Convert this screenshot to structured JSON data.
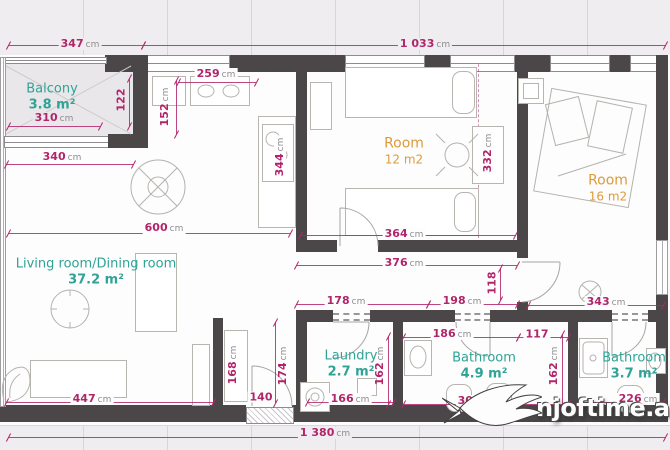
{
  "plan": {
    "rooms": [
      {
        "id": "balcony",
        "name": "Balcony",
        "area": "3.8 m²"
      },
      {
        "id": "living",
        "name": "Living room/Dining room",
        "area": "37.2 m²"
      },
      {
        "id": "room12",
        "name": "Room",
        "area": "12 m2"
      },
      {
        "id": "room16",
        "name": "Room",
        "area": "16 m2"
      },
      {
        "id": "laundry",
        "name": "Laundry",
        "area": "2.7 m²"
      },
      {
        "id": "bathroom-left",
        "name": "Bathroom",
        "area": "4.9 m²"
      },
      {
        "id": "bathroom-right",
        "name": "Bathroom",
        "area": "3.7 m²"
      }
    ],
    "dimensions": [
      {
        "id": "total-top-left",
        "value": "347",
        "unit": "cm"
      },
      {
        "id": "total-top-right",
        "value": "1 033",
        "unit": "cm"
      },
      {
        "id": "kitchen-width",
        "value": "259",
        "unit": "cm"
      },
      {
        "id": "balcony-depth",
        "value": "122",
        "unit": ""
      },
      {
        "id": "kitchen-depth",
        "value": "152",
        "unit": "cm"
      },
      {
        "id": "balcony-width",
        "value": "310",
        "unit": "cm"
      },
      {
        "id": "living-top-width",
        "value": "340",
        "unit": "cm"
      },
      {
        "id": "kitchen-height",
        "value": "344",
        "unit": "cm"
      },
      {
        "id": "living-width",
        "value": "600",
        "unit": "cm"
      },
      {
        "id": "room12-height",
        "value": "332",
        "unit": "cm"
      },
      {
        "id": "room12-width",
        "value": "364",
        "unit": "cm"
      },
      {
        "id": "corridor-width",
        "value": "376",
        "unit": "cm"
      },
      {
        "id": "corridor-jog",
        "value": "118",
        "unit": ""
      },
      {
        "id": "hall-left",
        "value": "178",
        "unit": "cm"
      },
      {
        "id": "hall-right",
        "value": "198",
        "unit": "cm"
      },
      {
        "id": "hall-room16",
        "value": "343",
        "unit": "cm"
      },
      {
        "id": "bathroom-left-width",
        "value": "186",
        "unit": "cm"
      },
      {
        "id": "bathroom-left-extra",
        "value": "117",
        "unit": ""
      },
      {
        "id": "laundry-width",
        "value": "166",
        "unit": "cm"
      },
      {
        "id": "laundry-height",
        "value": "162",
        "unit": "cm"
      },
      {
        "id": "bathroom-height",
        "value": "162",
        "unit": "cm"
      },
      {
        "id": "closet-height",
        "value": "168",
        "unit": "cm"
      },
      {
        "id": "entry-door-width",
        "value": "140",
        "unit": ""
      },
      {
        "id": "entry-height",
        "value": "174",
        "unit": "cm"
      },
      {
        "id": "living-bottom-width",
        "value": "447",
        "unit": "cm"
      },
      {
        "id": "bathroom-left-total",
        "value": "303",
        "unit": "cm"
      },
      {
        "id": "bathroom-right-width",
        "value": "226",
        "unit": "cm"
      },
      {
        "id": "total-bottom",
        "value": "1 380",
        "unit": "cm"
      }
    ],
    "watermark": {
      "text": "njoftime.al",
      "icon": "bird-swallow-icon"
    },
    "colors": {
      "dimension": "#b1256b",
      "room_teal": "#2fa396",
      "room_orange": "#dd9b3c",
      "wall": "#4b4749"
    }
  }
}
